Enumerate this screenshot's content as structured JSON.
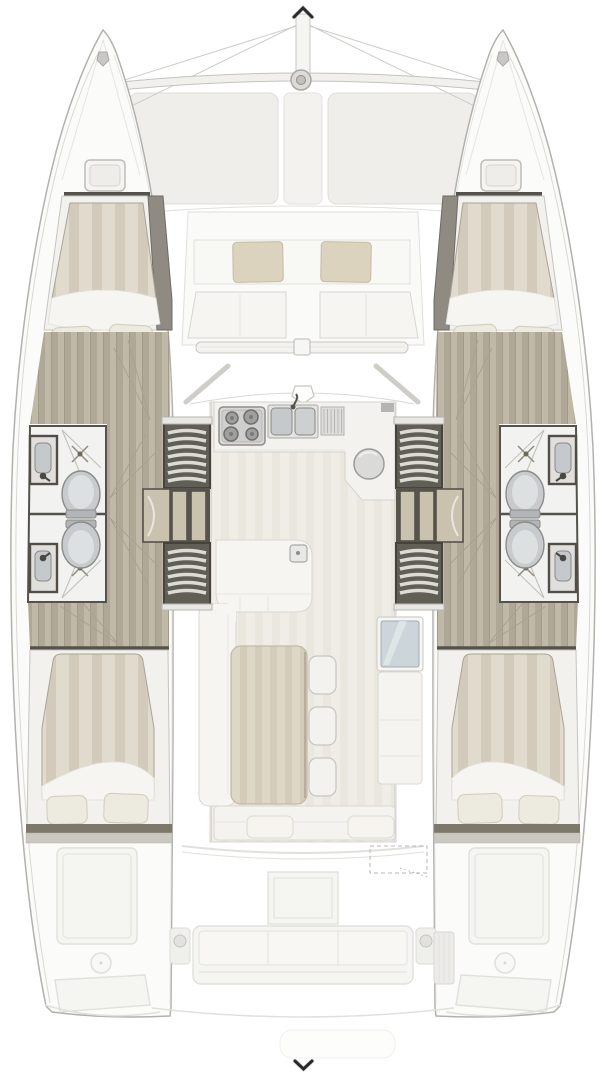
{
  "icons": {
    "bow_arrow": {
      "name": "chevron-up-icon",
      "glyph": "^"
    },
    "stern_arrow": {
      "name": "chevron-down-icon",
      "glyph": "v"
    }
  },
  "labels": {
    "floorplan": "Catamaran deck and interior floor plan, top view",
    "port_hull": "Port hull",
    "starboard_hull": "Starboard hull",
    "bow_rigging": "Bow, bowsprit and trampoline",
    "forward_cockpit": "Forward cockpit seating",
    "salon": "Salon and galley",
    "aft_cockpit": "Aft cockpit (ghosted)",
    "forward_cabin": "Forward double cabin",
    "aft_cabin": "Aft double cabin",
    "bathroom": "Bathroom with toilet, sink and shower",
    "stairs": "Companionway stairs",
    "galley": "Galley with stove and double sink",
    "dinette": "Dinette table with stools",
    "nav_station": "Navigation window and cabinet"
  },
  "features": {
    "hulls": 2,
    "double_berths": 4,
    "bathrooms": 4,
    "toilets": 4,
    "shower_drains": 4,
    "staircases": 4,
    "dining_stools": 3,
    "forward_cockpit_cushions": 2,
    "aft_bench_cushions": 3,
    "stove_burners": 4,
    "galley_sink_basins": 2
  },
  "palette": {
    "wood_base": "#c0b9a8",
    "wood_stripe": "#b0a896",
    "wood_line": "#a29b89",
    "duvet_base": "#e0dbcd",
    "duvet_stripe": "#d2cbbb",
    "sole_base": "#f0ede6",
    "sole_stripe": "#eae7df",
    "table_base": "#ddd7c5",
    "table_stripe": "#d3ccb8",
    "pillow": "#edebdf",
    "pillow_edge": "#d3cfc0",
    "hull_white": "#fbfbf9",
    "hull_edge": "#b2b1ad",
    "bed_platform": "#f2f1ed",
    "sheet_white": "#f6f5f1",
    "bathroom_floor": "#f2f2f0",
    "frame_dark": "#55524b",
    "stair_dark": "#615e55",
    "tread": "#dcdbd7",
    "wardrobe_tan": "#c9c2ae",
    "dark_band": "#8f8b82",
    "fixture": "#c6c9cb",
    "fixture_edge": "#8b8b87",
    "cushion": "#dbd3bd",
    "cushion_edge": "#c5bca4",
    "salon_white": "#f6f5f2",
    "salon_white_edge": "#d9d7d1",
    "ghost_fill": "#f5f5f2",
    "ghost_line": "#e1e0dc",
    "glass_blue": "#ccd6da",
    "shelf_dark": "#7d7869",
    "shelf_light": "#cbc8c1",
    "arrow_dark": "#232a33"
  }
}
